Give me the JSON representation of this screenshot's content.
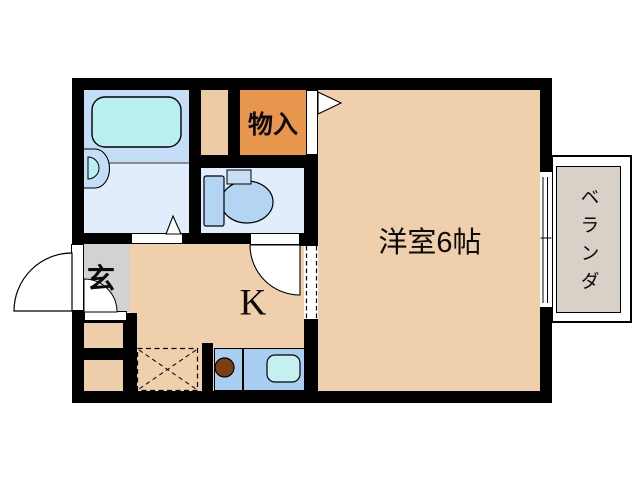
{
  "floorplan": {
    "labels": {
      "storage_closet": "物入",
      "western_room": "洋室6帖",
      "kitchen": "K",
      "entrance": "玄",
      "veranda": "ベランダ"
    },
    "colors": {
      "wall": "#000000",
      "room_tan": "#f0cfad",
      "storage_closet_orange": "#e8954e",
      "duct_column_tan": "#eccaa4",
      "bathroom_floor_blue": "#c5ddf6",
      "washroom_toilet_floor": "#e1edfb",
      "entrance_gray": "#d2d2d2",
      "veranda_gray": "#d7d1c7",
      "bathtub_cyan": "#b8f0f2",
      "fixture_blue": "#b3d4f2",
      "counter_blue": "#aacdf2",
      "kitchen_sink_cyan": "#c5f0f2",
      "burner_brown": "#7a4012",
      "storage_box_tan": "#eecdab"
    },
    "fixtures": [
      "bathtub",
      "washbasin",
      "toilet",
      "kitchen-counter",
      "stove-burner",
      "kitchen-sink",
      "appliance-space",
      "entrance-door",
      "toilet-door",
      "closet-door",
      "washroom-door",
      "sliding-window"
    ]
  }
}
